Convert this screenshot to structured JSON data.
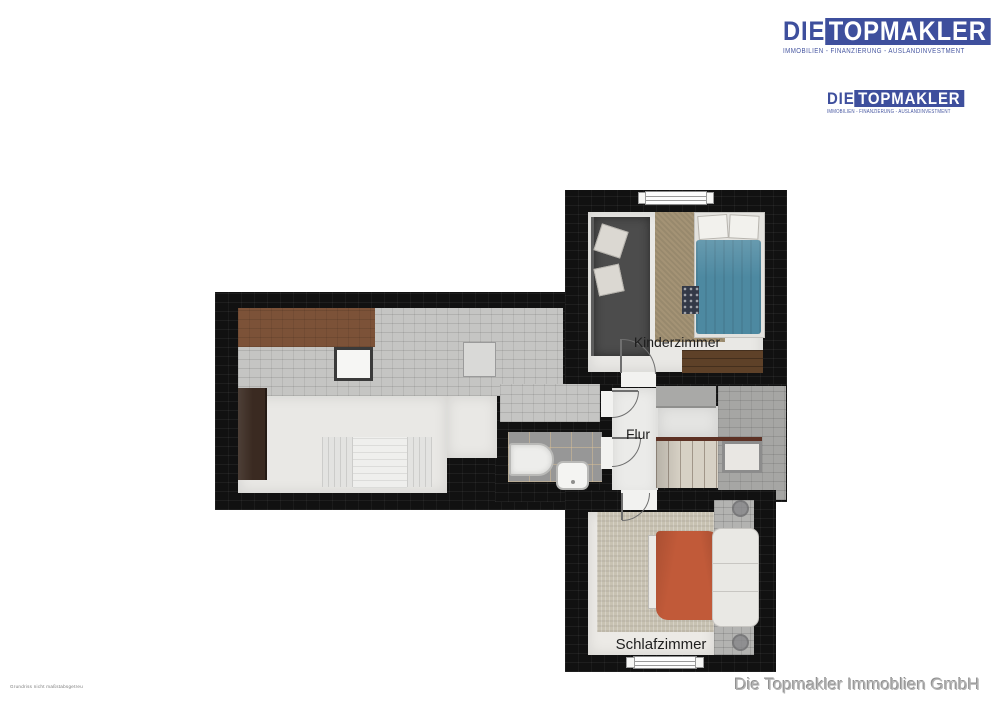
{
  "branding": {
    "logo": {
      "prefix": "DIE",
      "name": "TOPMAKLER",
      "tagline": "IMMOBILIEN - FINANZIERUNG - AUSLANDINVESTMENT"
    }
  },
  "floorplan": {
    "rooms": [
      {
        "label": "Kinderzimmer"
      },
      {
        "label": "Flur"
      },
      {
        "label": "Schlafzimmer"
      }
    ]
  },
  "footer": {
    "company": "Die Topmakler Immoblien GmbH",
    "fine_print": "Grundriss nicht maßstabsgetreu"
  },
  "palette": {
    "brand_blue": "#3e4f9d",
    "roof_dark": "#111111",
    "roof_gray": "#c5c5c3",
    "roof_brown": "#7c5238",
    "bed_kinderzimmer_blue": "#4d89a1",
    "bed_schlafzimmer_orange": "#c15a39"
  }
}
